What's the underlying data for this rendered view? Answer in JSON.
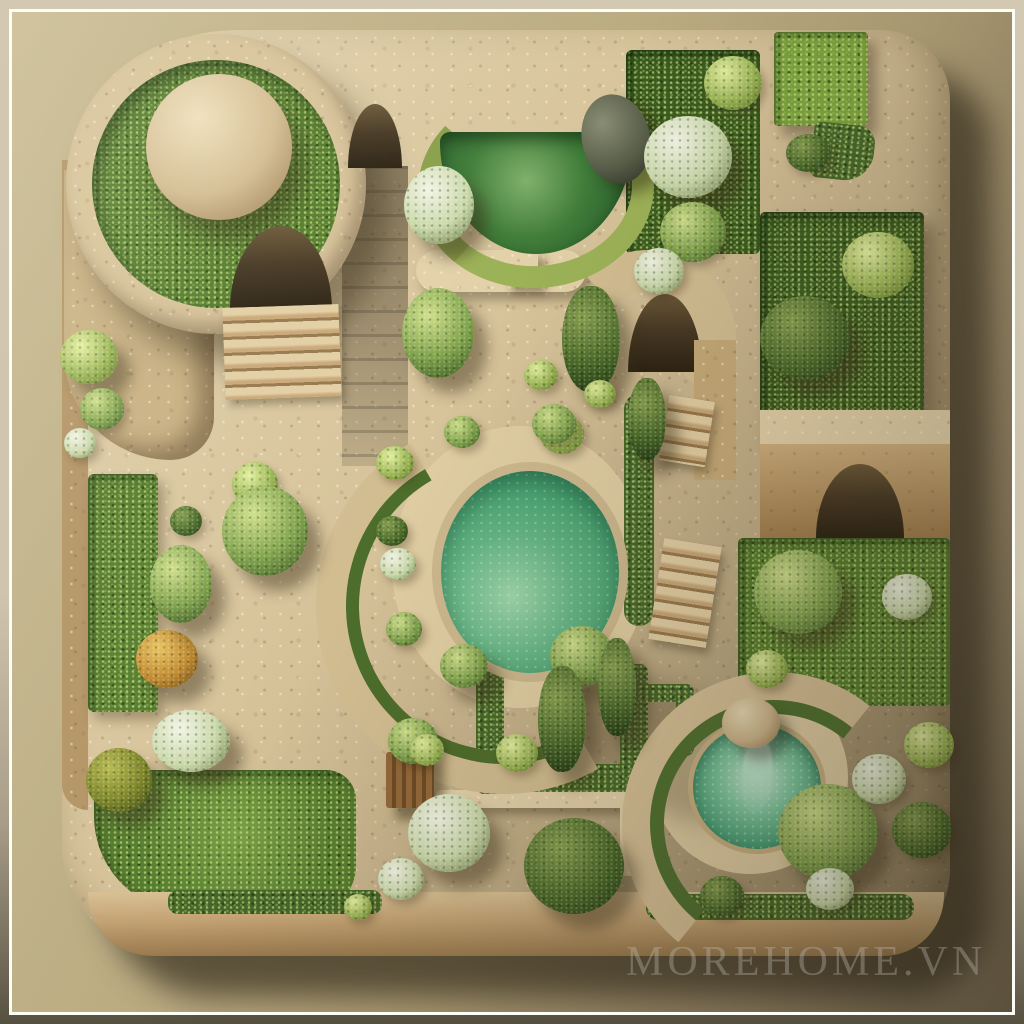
{
  "scene": {
    "type": "3D rendered aerial view",
    "subject": "Miniature square stone garden model with hedge beds, topiary, staircases, arched passages, two green pools and a mushroom fountain",
    "watermark": "MOREHOME.VN"
  },
  "palette": {
    "backdrop": "#b9aa80",
    "mat": "#cfc5ae",
    "frame": "#ffffff",
    "stone": "#d7c39a",
    "stone_shaded": "#a07c48",
    "foliage_dark": "#3c5c20",
    "foliage_mid": "#567d2e",
    "foliage_bright": "#9ab553",
    "flowers_white": "#e9efdc",
    "autumn_tree": "#c08a2e",
    "pool_water": "#46a272",
    "dark_pool_water": "#2e6b33",
    "fountain_water": "#3f9a71",
    "cast_shadow": "#3b372a"
  }
}
